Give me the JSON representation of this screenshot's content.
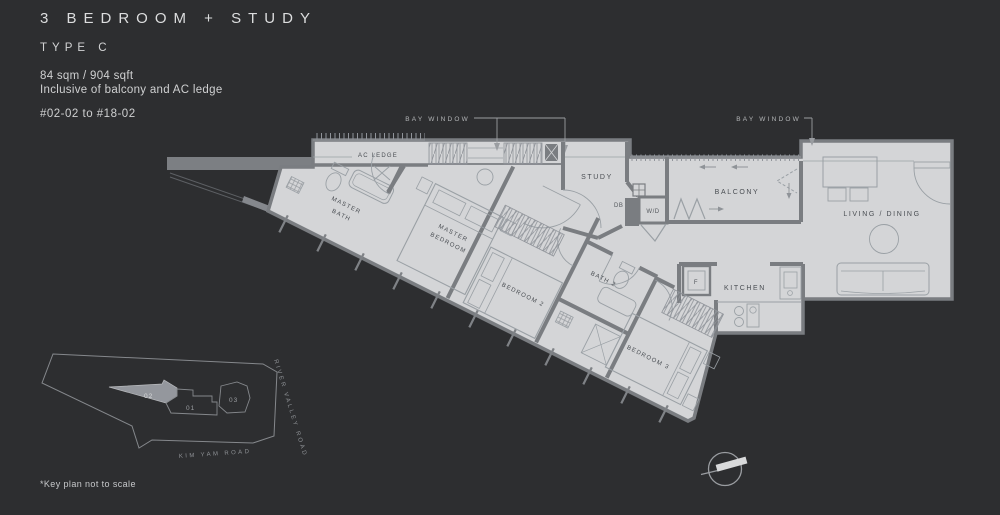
{
  "header": {
    "title": "3 BEDROOM + STUDY",
    "plan_type": "TYPE C",
    "area": "84 sqm / 904 sqft",
    "area_note": "Inclusive of balcony and AC ledge",
    "unit_range": "#02-02 to #18-02"
  },
  "floorplan": {
    "annotations": {
      "bay_window_left": "BAY WINDOW",
      "bay_window_right": "BAY WINDOW"
    },
    "rooms": {
      "ac_ledge": "AC LEDGE",
      "master_bath_l1": "MASTER",
      "master_bath_l2": "BATH",
      "master_bedroom_l1": "MASTER",
      "master_bedroom_l2": "BEDROOM",
      "bedroom_2": "BEDROOM 2",
      "bath_2": "BATH 2",
      "bedroom_3": "BEDROOM 3",
      "study": "STUDY",
      "balcony": "BALCONY",
      "living_dining": "LIVING / DINING",
      "kitchen": "KITCHEN"
    },
    "fixtures": {
      "washer_dryer": "W/D",
      "distribution_board": "DB",
      "fridge": "F"
    }
  },
  "keyplan": {
    "unit_01": "01",
    "unit_02": "02",
    "unit_03": "03",
    "highlighted_unit": "02",
    "road_river_valley": "RIVER VALLEY ROAD",
    "road_kim_yam": "KIM YAM ROAD",
    "note": "*Key plan not to scale"
  },
  "colors": {
    "background": "#2d2e30",
    "floor": "#d4d5d7",
    "wall": "#7a7d81",
    "room_label": "#4a4e53",
    "light_text": "#cfd0d1",
    "keyplan_unit_fill": "#94979d"
  }
}
